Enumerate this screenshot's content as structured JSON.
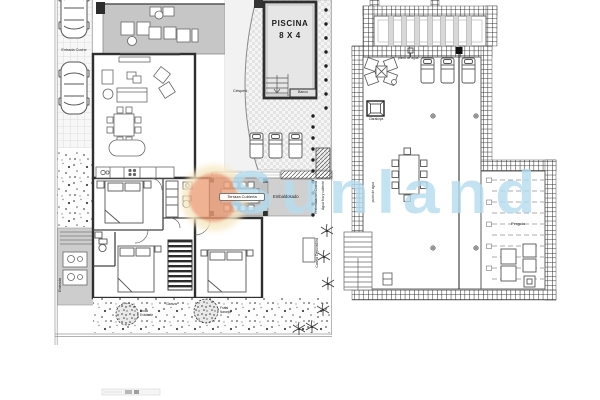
{
  "watermark": {
    "brand": "Sunland",
    "text_color": "#b5dcf0",
    "sun_color": "#ec9f78",
    "halo_color": "#f6e8c2"
  },
  "left_plan": {
    "driveway_label": "Entrada Coche",
    "entrance_label": "Entrada",
    "pool": {
      "name": "PISCINA",
      "size": "8 X 4",
      "bench": "Banco"
    },
    "garden": {
      "lawn": "Césped",
      "gravel": "Grava",
      "tree1": "Frutal Existente",
      "tree2": "Frutal Naranjo"
    },
    "terrace": {
      "covered": "Terraza Cubierta",
      "paved": "Embaldosado"
    },
    "services": {
      "preinstall": "Preinstalación Cocina",
      "hot_cold_water": "Agua fría y caliente",
      "pool_equipment": "Caseta Depuradora"
    }
  },
  "right_plan": {
    "pergola": "Pergola",
    "water_point": "punto de agua",
    "skylight": "Claraboya",
    "water_point_2": "punto de agua"
  }
}
